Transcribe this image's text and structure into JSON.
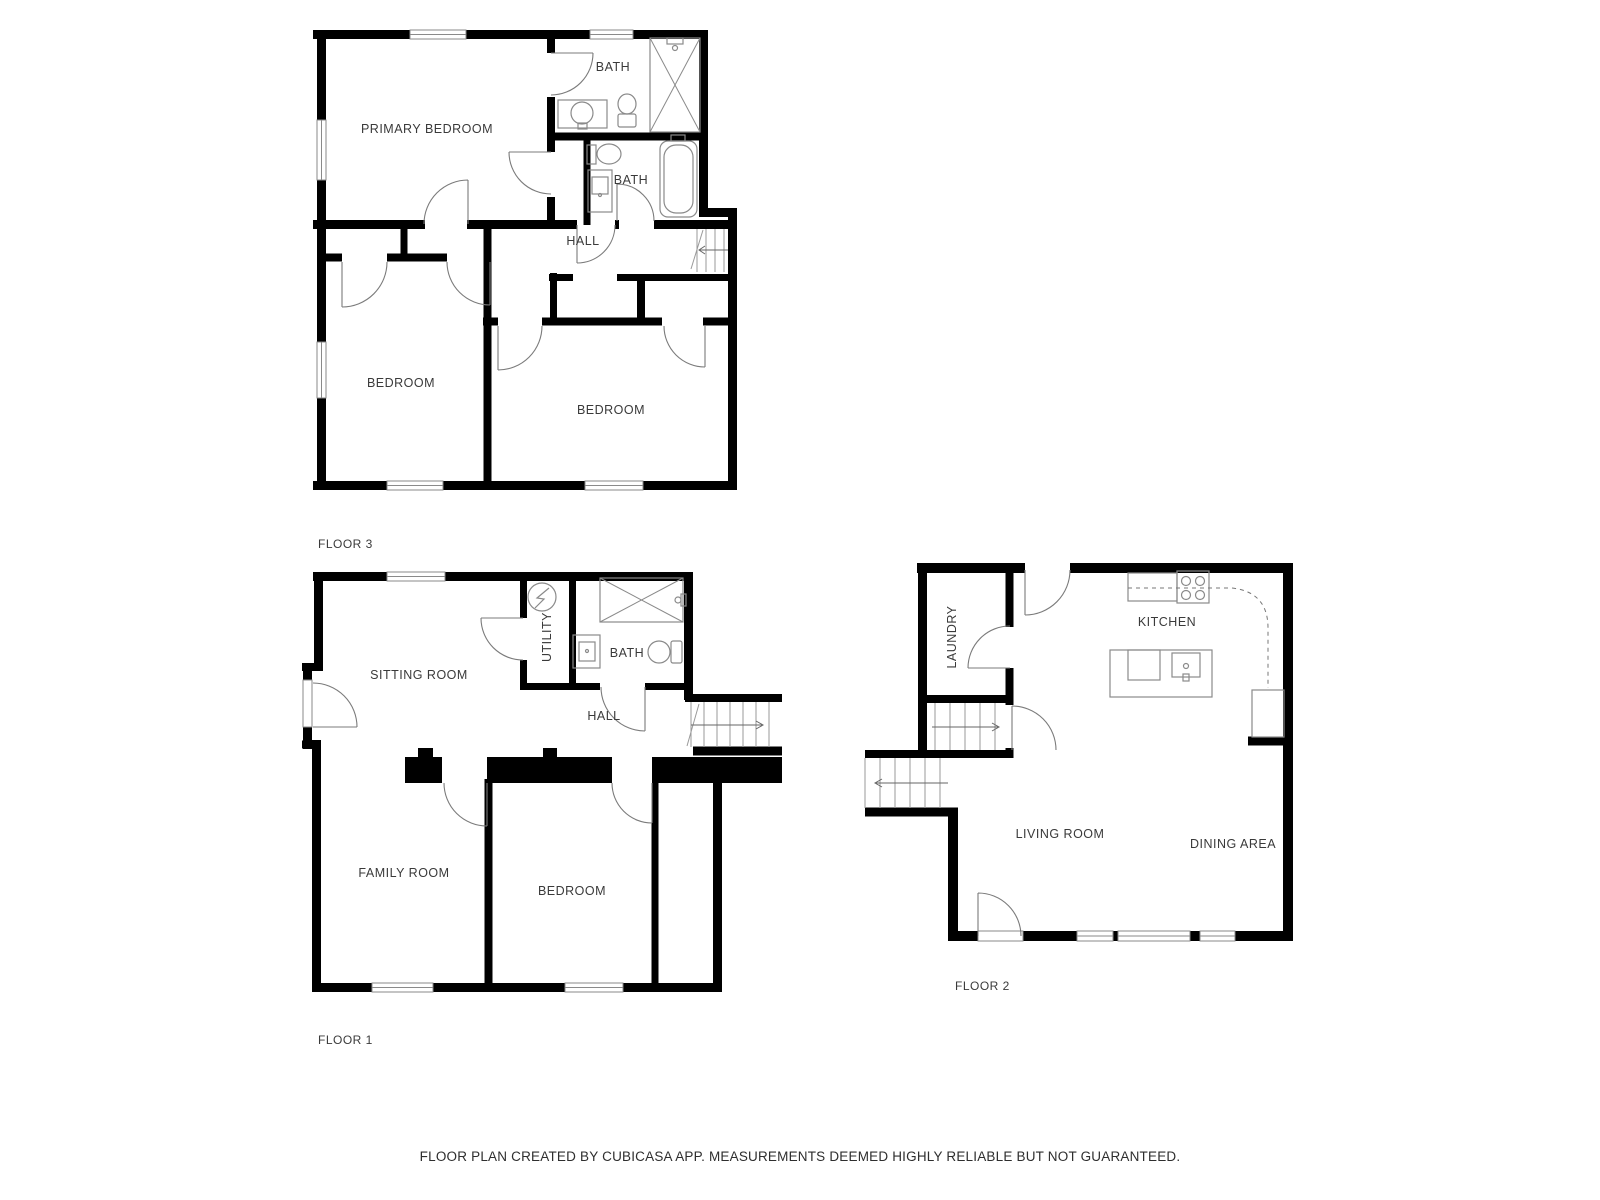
{
  "floor3": {
    "label": "FLOOR 3",
    "primary_bedroom": "PRIMARY BEDROOM",
    "bath_top": "BATH",
    "bath_mid": "BATH",
    "hall": "HALL",
    "bedroom_left": "BEDROOM",
    "bedroom_right": "BEDROOM"
  },
  "floor1": {
    "label": "FLOOR 1",
    "sitting_room": "SITTING ROOM",
    "utility": "UTILITY",
    "bath": "BATH",
    "hall": "HALL",
    "family_room": "FAMILY ROOM",
    "bedroom": "BEDROOM"
  },
  "floor2": {
    "label": "FLOOR 2",
    "laundry": "LAUNDRY",
    "kitchen": "KITCHEN",
    "living_room": "LIVING ROOM",
    "dining_area": "DINING AREA"
  },
  "footer": {
    "disclaimer": "FLOOR PLAN CREATED BY CUBICASA APP. MEASUREMENTS DEEMED HIGHLY RELIABLE BUT NOT GUARANTEED."
  },
  "colors": {
    "wall": "#000000",
    "fixture": "#8a8a8a",
    "door": "#7b7b7b",
    "label": "#3a3a3a",
    "background": "#ffffff"
  }
}
